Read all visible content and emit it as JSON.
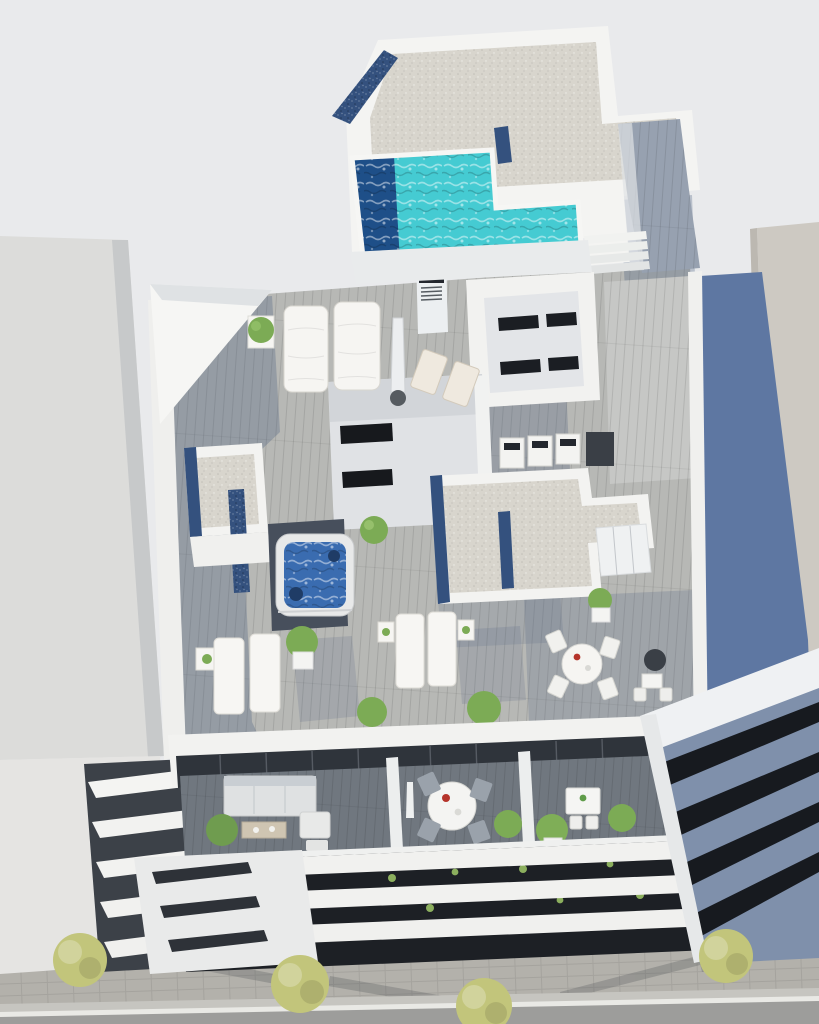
{
  "meta": {
    "image_kind": "3d-architectural-aerial-render",
    "subject": "modern white apartment building rooftop solarium with swimming pool, jacuzzi and terraces, viewed from above; street with trees below"
  },
  "palette": {
    "background": "#e9eaec",
    "white_wall": "#f4f4f2",
    "white_wall_dim": "#e6e8e9",
    "wall_facet": "#d7dadd",
    "left_building": "#dcdcda",
    "left_building_edge": "#c7c9ca",
    "right_building_beige": "#cdc9c2",
    "slate_side_wall": "#5e77a2",
    "slate_band_face": "#7f90ab",
    "gravel_roof": "#d8d5cd",
    "pebble_navy": "#34517e",
    "pool_turquoise": "#45cbd2",
    "pool_deep": "#1e4f88",
    "deck_light": "#b7b8b5",
    "deck_sunlit": "#c6c7c5",
    "deck_corridor": "#97a1b0",
    "deck_shadow_tint": "#4d5f7e",
    "terrace_deck": "#70777f",
    "glazing_dark": "#2f343b",
    "window_black": "#1b1e23",
    "facade_dark_gap": "#1d2025",
    "jacuzzi_water": "#3a6cb0",
    "foliage": "#7cab55",
    "tree_canopy": "#c2c57b",
    "sidewalk": "#b3b1ab",
    "road": "#9d9d9b",
    "road_line": "#e9e9e5",
    "furniture_white": "#f6f5f2",
    "furniture_beige": "#efe9df",
    "furniture_gray": "#9aa2ab",
    "sofa_gray": "#dfe1e2",
    "accent_red": "#b5342b",
    "dark_equipment": "#23272e",
    "umbrella_dark": "#3a3f46",
    "balcony_gap_dark": "#3c4148"
  },
  "scene": {
    "rooftop_features": [
      "swimming-pool",
      "pool-deep-end",
      "pool-steps",
      "outdoor-shower-column",
      "gravel-roof",
      "navy-pebble-border",
      "stair-corridor",
      "lightwell",
      "stair-skylight",
      "ac-units",
      "daybeds",
      "closed-parasol",
      "deck-chairs",
      "sun-loungers",
      "side-tables",
      "jacuzzi",
      "planters",
      "potted-plants",
      "round-dining-set",
      "bistro-set",
      "glass-sliding-doors"
    ],
    "lower_level_features": [
      "balcony-terraces",
      "outdoor-sofa",
      "coffee-table",
      "armchair",
      "round-dining-table",
      "square-bistro-table",
      "closed-parasol",
      "potted-plants",
      "glass-facade",
      "white-railing"
    ],
    "street_features": [
      "paved-sidewalk",
      "street-trees",
      "tree-shadows",
      "asphalt-road",
      "lane-marking"
    ],
    "neighbor_buildings": [
      "plain-left-building",
      "stepped-balconies",
      "beige-right-building",
      "slate-banded-building"
    ],
    "counts": {
      "daybeds": 2,
      "sun_loungers": 4,
      "deck_chairs": 2,
      "street_trees": 4,
      "facade_bands": 3
    }
  }
}
